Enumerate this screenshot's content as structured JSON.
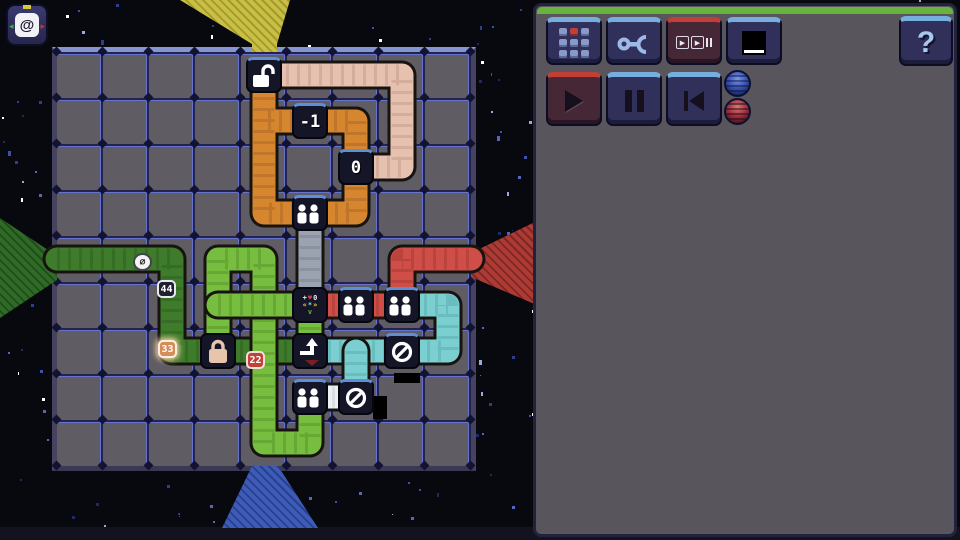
{
  "hud": {
    "at_button_label": "@"
  },
  "toolbar": {
    "buttons": [
      {
        "name": "level-select-button",
        "icon": "keypad-icon"
      },
      {
        "name": "tools-button",
        "icon": "wrench-icon"
      },
      {
        "name": "step-mode-button",
        "icon": "step-icon"
      },
      {
        "name": "screen-button",
        "icon": "screen-icon"
      }
    ],
    "help_label": "?"
  },
  "playback": {
    "loop_count": "1",
    "buttons": [
      {
        "name": "play-button",
        "icon": "play-icon"
      },
      {
        "name": "pause-button",
        "icon": "pause-icon"
      },
      {
        "name": "restart-button",
        "icon": "skip-back-icon"
      }
    ]
  },
  "speed": {
    "marks": [
      "▶▶",
      "▶▶▶"
    ]
  },
  "tabs": {
    "count": 5,
    "selected": 3
  },
  "instructions": {
    "rows": [
      {
        "dir": "up",
        "color": "#d9cf4a",
        "badges": [
          {
            "label": "03",
            "variant": "dark",
            "chevron": true
          }
        ]
      },
      {
        "dir": "left",
        "color": "#3f8f35",
        "badges": [
          {
            "label": "00",
            "variant": "black",
            "chevron": true
          },
          {
            "label": "11",
            "variant": "maroon",
            "chevron": true
          },
          {
            "label": "22",
            "variant": "red",
            "chevron": true
          },
          {
            "label": "33",
            "variant": "orange",
            "chevron": true
          },
          {
            "label": "44",
            "variant": "navy",
            "chevron": true
          },
          {
            "label": "∅",
            "variant": "white",
            "chevron": true
          }
        ]
      },
      {
        "dir": "right",
        "color": "#d04a4a",
        "badges": [
          {
            "label": "33",
            "variant": "orange",
            "chevron": false
          }
        ]
      }
    ]
  },
  "board": {
    "origin": [
      57,
      52
    ],
    "cell": 46,
    "cols": 9,
    "rows": 9,
    "funnels": [
      {
        "side": "top",
        "name": "funnel-top-yellow",
        "color": "#c9bf45",
        "shade": "#a39a2e"
      },
      {
        "side": "left",
        "name": "funnel-left-green",
        "color": "#2f6b26",
        "shade": "#214d1a"
      },
      {
        "side": "right",
        "name": "funnel-right-red",
        "color": "#ad3a34",
        "shade": "#7e2823"
      },
      {
        "side": "bottom",
        "name": "funnel-bottom-blue",
        "color": "#3d5cba",
        "shade": "#2a408a"
      }
    ],
    "pipes": [
      {
        "name": "pink-pipe",
        "color": "#e6c1b0",
        "shade": "#c49a88",
        "pts": [
          [
            4,
            0
          ],
          [
            7,
            0
          ],
          [
            7,
            2
          ],
          [
            6,
            2
          ]
        ]
      },
      {
        "name": "orange-pipe",
        "color": "#d5862f",
        "shade": "#a96425",
        "pts": [
          [
            4,
            0
          ],
          [
            4,
            3
          ],
          [
            6,
            3
          ],
          [
            6,
            1
          ],
          [
            4,
            1
          ]
        ]
      },
      {
        "name": "gray-pipe",
        "color": "#9ba3b0",
        "shade": "#79828f",
        "pts": [
          [
            5,
            3
          ],
          [
            5,
            5
          ]
        ]
      },
      {
        "name": "darkgreen-pipe",
        "color": "#3e7c2b",
        "shade": "#2d5d1e",
        "pts": [
          [
            -0.5,
            4
          ],
          [
            2,
            4
          ],
          [
            2,
            6
          ],
          [
            5,
            6
          ]
        ]
      },
      {
        "name": "green-pipe-main",
        "color": "#77bd3f",
        "shade": "#569327",
        "pts": [
          [
            3,
            6
          ],
          [
            3,
            4
          ],
          [
            4,
            4
          ],
          [
            4,
            8
          ],
          [
            5,
            8
          ],
          [
            5,
            7
          ]
        ]
      },
      {
        "name": "green-pipe-mid",
        "color": "#77bd3f",
        "shade": "#569327",
        "pts": [
          [
            3,
            5
          ],
          [
            5,
            5
          ]
        ]
      },
      {
        "name": "green-pipe-stub",
        "color": "#77bd3f",
        "shade": "#569327",
        "pts": [
          [
            5,
            5
          ],
          [
            5,
            6
          ]
        ]
      },
      {
        "name": "red-pipe-row",
        "color": "#cf4f48",
        "shade": "#a53733",
        "pts": [
          [
            5,
            5
          ],
          [
            7,
            5
          ]
        ]
      },
      {
        "name": "red-pipe-exit",
        "color": "#cf4f48",
        "shade": "#a53733",
        "pts": [
          [
            7,
            5
          ],
          [
            7,
            4
          ],
          [
            8.5,
            4
          ]
        ]
      },
      {
        "name": "cyan-pipe-loop",
        "color": "#7ccfd1",
        "shade": "#57abad",
        "pts": [
          [
            7,
            5
          ],
          [
            8,
            5
          ],
          [
            8,
            6
          ],
          [
            5,
            6
          ]
        ]
      },
      {
        "name": "cyan-pipe-stub",
        "color": "#7ccfd1",
        "shade": "#57abad",
        "pts": [
          [
            6,
            6
          ],
          [
            6,
            7
          ]
        ]
      },
      {
        "name": "white-pipe",
        "color": "#edf0f3",
        "shade": "#c6ccd4",
        "pts": [
          [
            5,
            7
          ],
          [
            6,
            7
          ]
        ]
      }
    ],
    "tiles": [
      {
        "c": 4,
        "r": 0,
        "type": "lock-open"
      },
      {
        "c": 5,
        "r": 1,
        "type": "number",
        "label": "-1"
      },
      {
        "c": 6,
        "r": 2,
        "type": "number",
        "label": "0"
      },
      {
        "c": 5,
        "r": 3,
        "type": "people"
      },
      {
        "c": 5,
        "r": 5,
        "type": "logic"
      },
      {
        "c": 6,
        "r": 5,
        "type": "people"
      },
      {
        "c": 7,
        "r": 5,
        "type": "people"
      },
      {
        "c": 3,
        "r": 6,
        "type": "lock-closed"
      },
      {
        "c": 5,
        "r": 6,
        "type": "redirect"
      },
      {
        "c": 7,
        "r": 6,
        "type": "null"
      },
      {
        "c": 5,
        "r": 7,
        "type": "people"
      },
      {
        "c": 6,
        "r": 7,
        "type": "null"
      }
    ],
    "badges": [
      {
        "x": 143,
        "y": 262,
        "label": "∅",
        "variant": "white"
      },
      {
        "x": 167,
        "y": 289,
        "label": "44",
        "variant": "navy"
      },
      {
        "x": 168,
        "y": 349,
        "label": "33",
        "variant": "orange"
      },
      {
        "x": 256,
        "y": 360,
        "label": "22",
        "variant": "red"
      }
    ],
    "shadows": [
      {
        "x": 373,
        "y": 396,
        "w": 14,
        "h": 23
      },
      {
        "x": 394,
        "y": 373,
        "w": 26,
        "h": 10
      }
    ],
    "logic_tile_glyphs": [
      [
        {
          "t": "+",
          "c": "#e8e8f0"
        },
        {
          "t": "♥",
          "c": "#d04040"
        },
        {
          "t": "0",
          "c": "#e8e8f0"
        }
      ],
      [
        {
          "t": "«",
          "c": "#e8c83a"
        },
        {
          "t": "*",
          "c": "#8fd4e4"
        },
        {
          "t": "»",
          "c": "#e8c83a"
        }
      ],
      [
        {
          "t": "v",
          "c": "#6fae3a"
        }
      ]
    ]
  }
}
